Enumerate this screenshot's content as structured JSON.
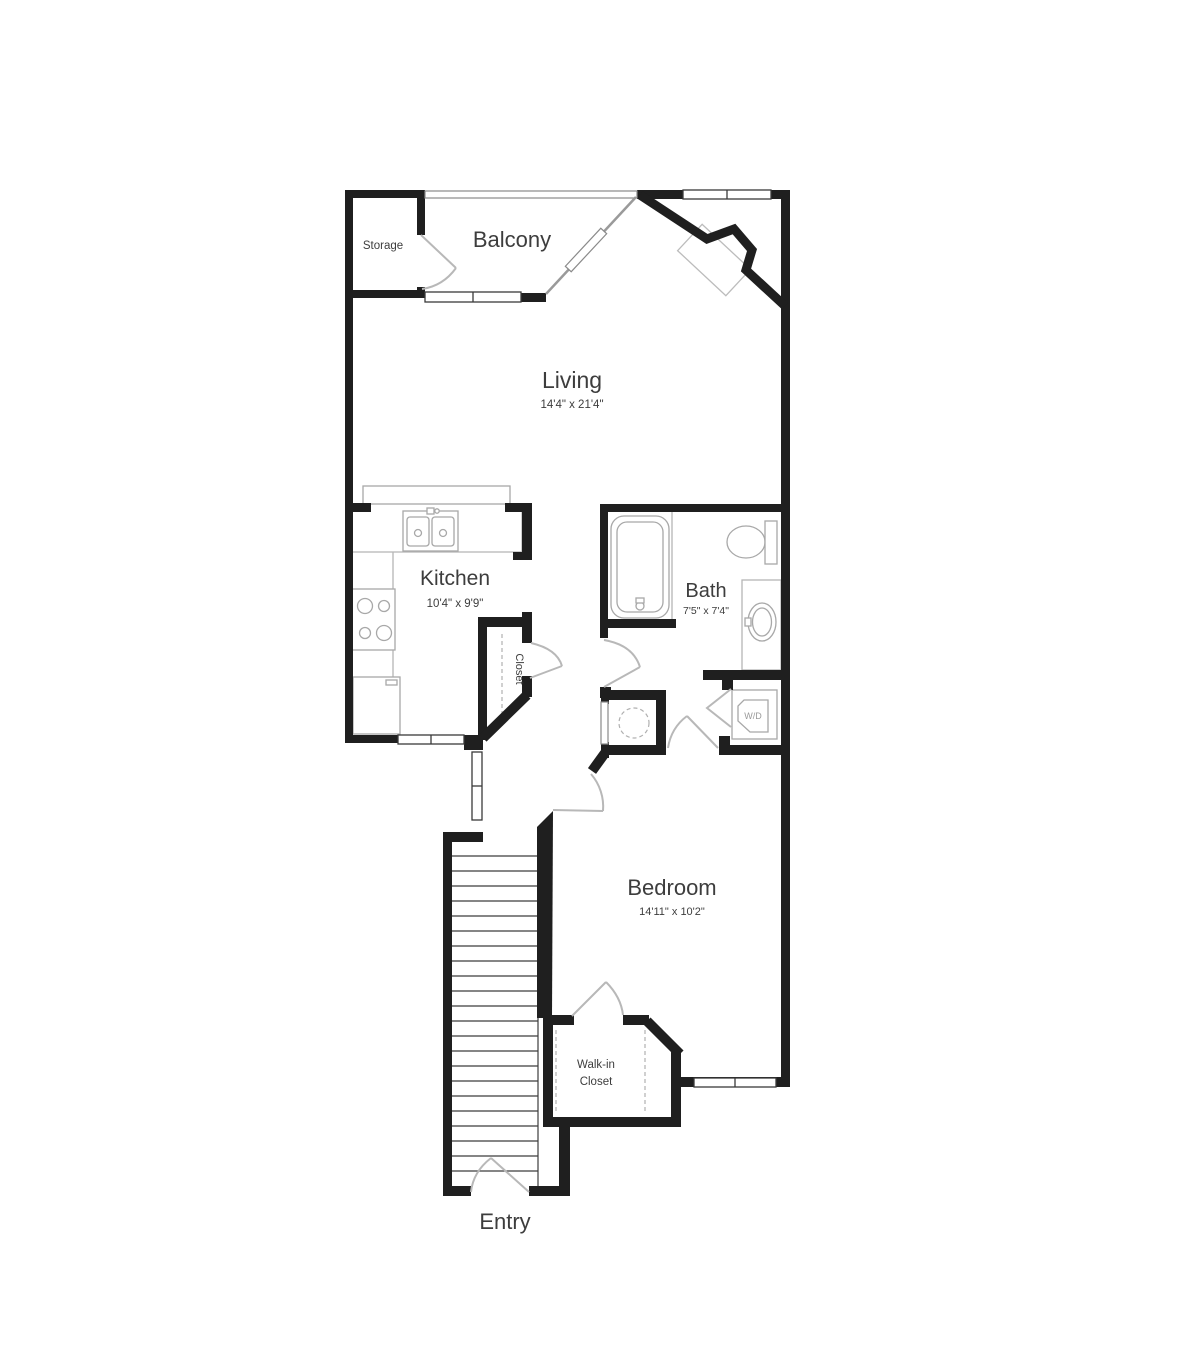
{
  "floor_plan": {
    "rooms": {
      "storage": {
        "name": "Storage"
      },
      "balcony": {
        "name": "Balcony"
      },
      "living": {
        "name": "Living",
        "dims": "14'4\" x 21'4\""
      },
      "kitchen": {
        "name": "Kitchen",
        "dims": "10'4\" x 9'9\""
      },
      "closet": {
        "name": "Closet"
      },
      "bath": {
        "name": "Bath",
        "dims": "7'5\" x 7'4\""
      },
      "washer_dryer": {
        "name": "W/D"
      },
      "bedroom": {
        "name": "Bedroom",
        "dims": "14'11\" x 10'2\""
      },
      "walk_in_closet": {
        "name_line1": "Walk-in",
        "name_line2": "Closet"
      },
      "entry": {
        "name": "Entry"
      }
    },
    "colors": {
      "wall": "#1f1f1f",
      "fixture_outline": "#a8a8a8",
      "door_swing": "#b8b8b8",
      "text": "#3d3d3d",
      "background": "#ffffff"
    }
  }
}
